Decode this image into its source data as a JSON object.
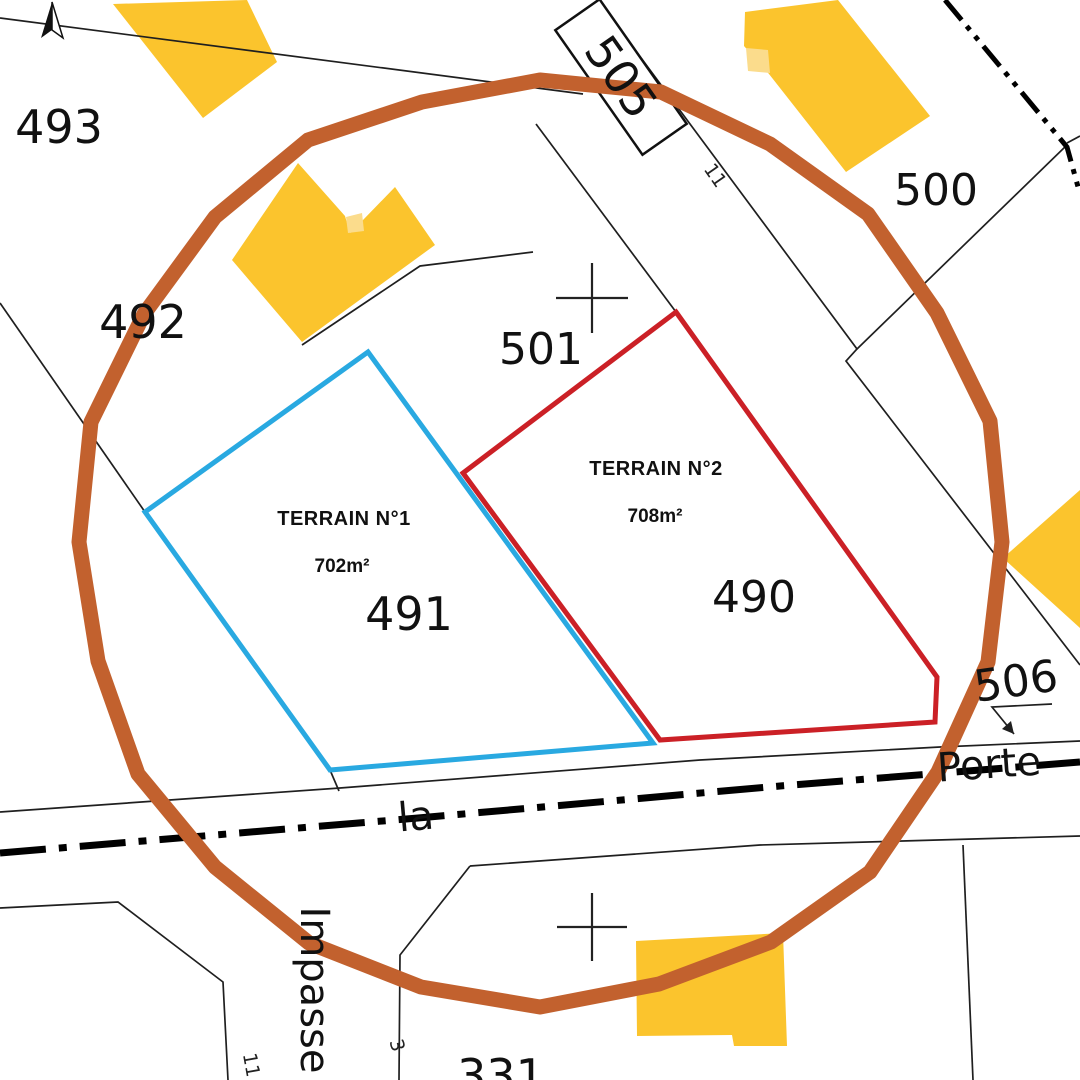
{
  "title": "Plan cadastral - terrains à vendre",
  "colors": {
    "terrain1": "#29A9E1",
    "terrain2": "#CB2026",
    "highlight_circle": "#C2612E",
    "building": "#FBC42D",
    "building_light": "#FBDC8C",
    "background": "#FFFFFF",
    "boundary_line": "#1F1F1F"
  },
  "parcels": {
    "p493": "493",
    "p492": "492",
    "p501": "501",
    "p500": "500",
    "p490": "490",
    "p491": "491",
    "p506": "506",
    "p331": "331",
    "p505": "505"
  },
  "house_numbers": {
    "n11_top": "11",
    "n11_bottom": "11",
    "n3": "3"
  },
  "streets": {
    "impasse": "Impasse",
    "la": "la",
    "porte": "Porte"
  },
  "terrains": {
    "t1": {
      "name": "TERRAIN N°1",
      "area": "702m²"
    },
    "t2": {
      "name": "TERRAIN N°2",
      "area": "708m²"
    }
  }
}
